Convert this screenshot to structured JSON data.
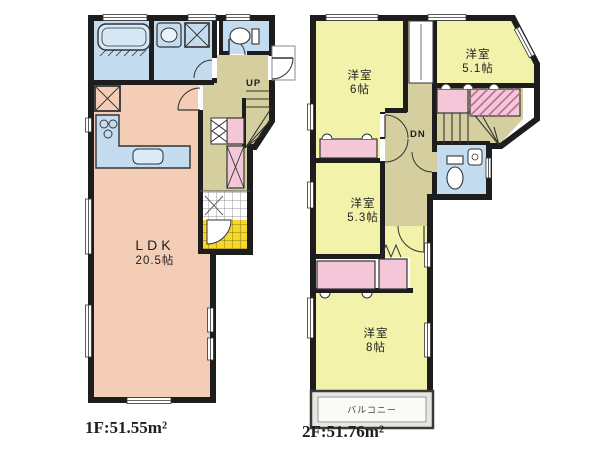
{
  "floors": [
    {
      "name": "1F",
      "area_label": "1F:51.55m²",
      "stairs_label": "UP",
      "rooms": [
        {
          "key": "ldk",
          "label": "LDK",
          "size": "20.5帖"
        }
      ]
    },
    {
      "name": "2F",
      "area_label": "2F:51.76m²",
      "stairs_label": "DN",
      "balcony_label": "バルコニー",
      "rooms": [
        {
          "key": "west-room-6",
          "label": "洋室",
          "size": "6帖"
        },
        {
          "key": "west-room-5-1",
          "label": "洋室",
          "size": "5.1帖"
        },
        {
          "key": "west-room-5-3",
          "label": "洋室",
          "size": "5.3帖"
        },
        {
          "key": "west-room-8",
          "label": "洋室",
          "size": "8帖"
        }
      ]
    }
  ],
  "colors": {
    "wall": "#1d1d1d",
    "living": "#f4cdb6",
    "bedroom": "#f2f2ab",
    "hall": "#d5cfa0",
    "wet_area": "#c3dcef",
    "closet": "#f3c7d8",
    "entrance_tile": "#f6d72c",
    "balcony": "#e7e6e0"
  }
}
